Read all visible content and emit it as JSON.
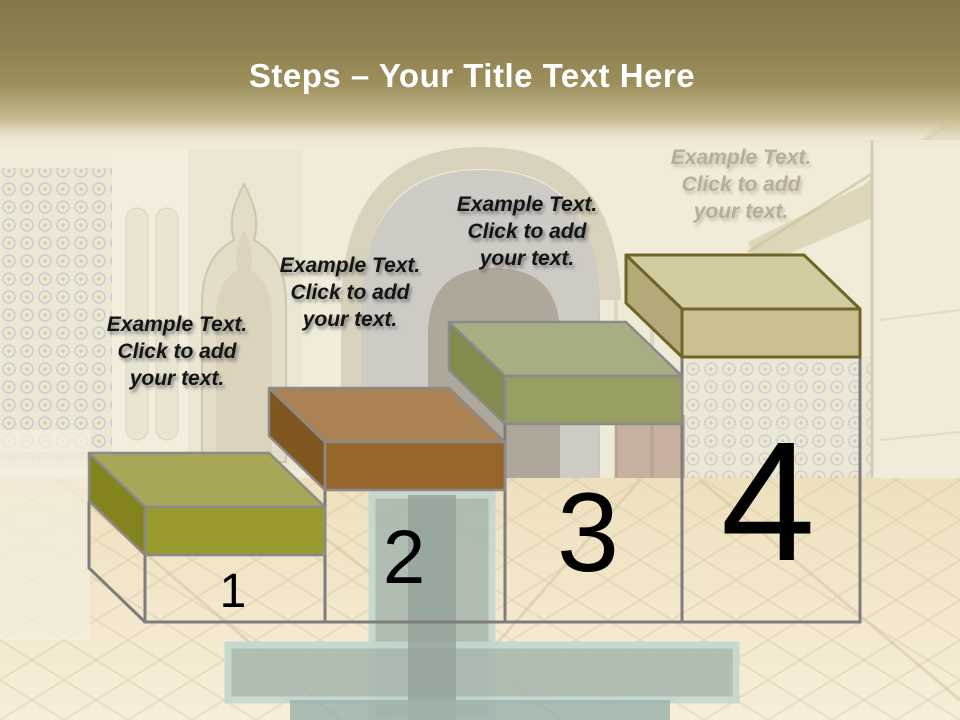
{
  "header": {
    "title_bold": "Steps",
    "title_rest": " – Your Title Text Here",
    "gradient_top": "#84774a",
    "gradient_mid": "#9c8f5c",
    "gradient_bottom": "#f1ebd9",
    "title_color": "#ffffff"
  },
  "wireframe": {
    "color": "#7d7d7d"
  },
  "steps": [
    {
      "number": "1",
      "label": "Example Text.\nClick  to add\nyour text.",
      "colors": {
        "top": "#a7a757",
        "front": "#999a2e",
        "side": "#84841f",
        "outline": "#8a8a8a"
      }
    },
    {
      "number": "2",
      "label": "Example Text.\nClick  to add\nyour text.",
      "colors": {
        "top": "#ac8154",
        "front": "#97662b",
        "side": "#82571f",
        "outline": "#8a8a8a"
      }
    },
    {
      "number": "3",
      "label": "Example Text.\nClick  to add\nyour text.",
      "colors": {
        "top": "#a9ae82",
        "front": "#989e62",
        "side": "#848a4e",
        "outline": "#8a8a8a"
      }
    },
    {
      "number": "4",
      "label": "Example Text.\nClick  to add\nyour text.",
      "colors": {
        "top": "#d3cba0",
        "front": "#c9c091",
        "side": "#b3a979",
        "outline": "#6e6526"
      }
    }
  ]
}
